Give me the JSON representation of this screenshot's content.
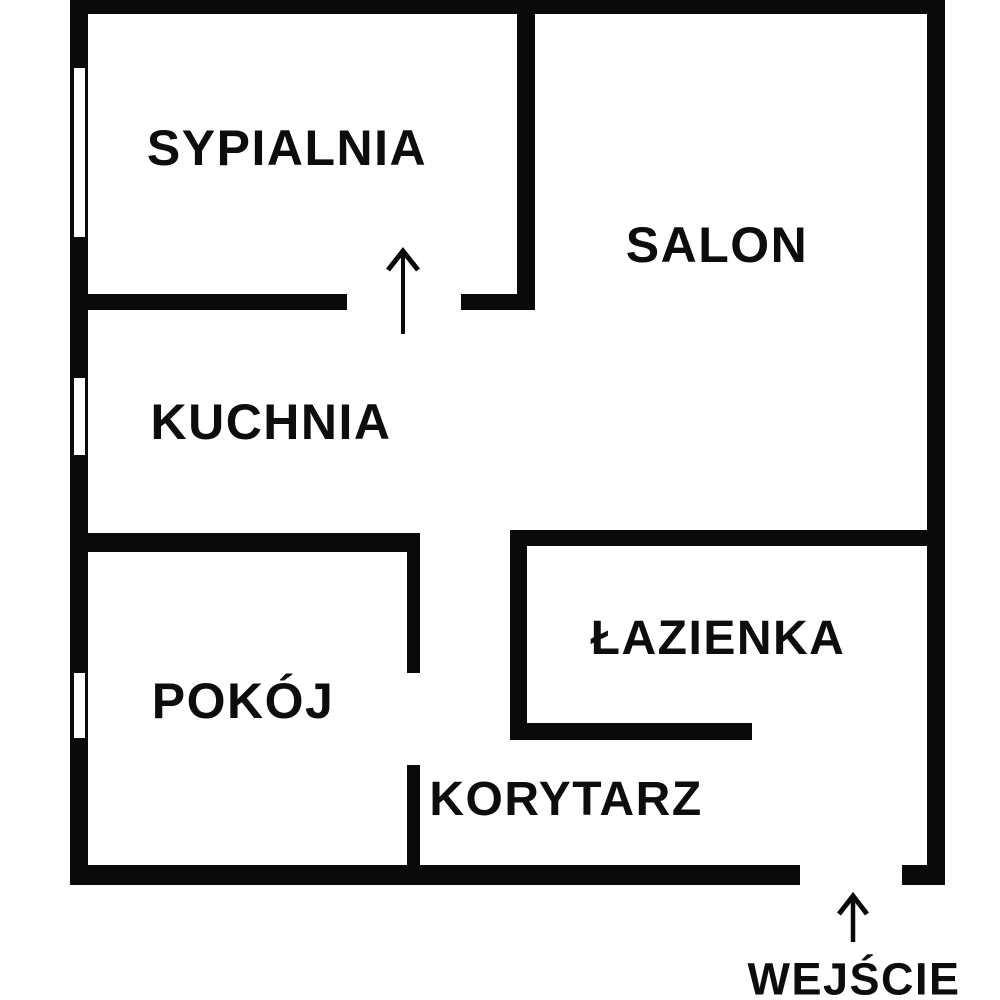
{
  "colors": {
    "wall": "#0a0a0a",
    "background": "#ffffff",
    "text": "#0d0d0d"
  },
  "rooms": [
    {
      "id": "sypialnia",
      "label": "SYPIALNIA"
    },
    {
      "id": "salon",
      "label": "SALON"
    },
    {
      "id": "kuchnia",
      "label": "KUCHNIA"
    },
    {
      "id": "pokoj",
      "label": "POKÓJ"
    },
    {
      "id": "lazienka",
      "label": "ŁAZIENKA"
    },
    {
      "id": "korytarz",
      "label": "KORYTARZ"
    }
  ],
  "entrance": {
    "label": "WEJŚCIE",
    "arrow_icon": "arrow-up"
  },
  "doors": {
    "sypialnia_door_icon": "arrow-up"
  }
}
